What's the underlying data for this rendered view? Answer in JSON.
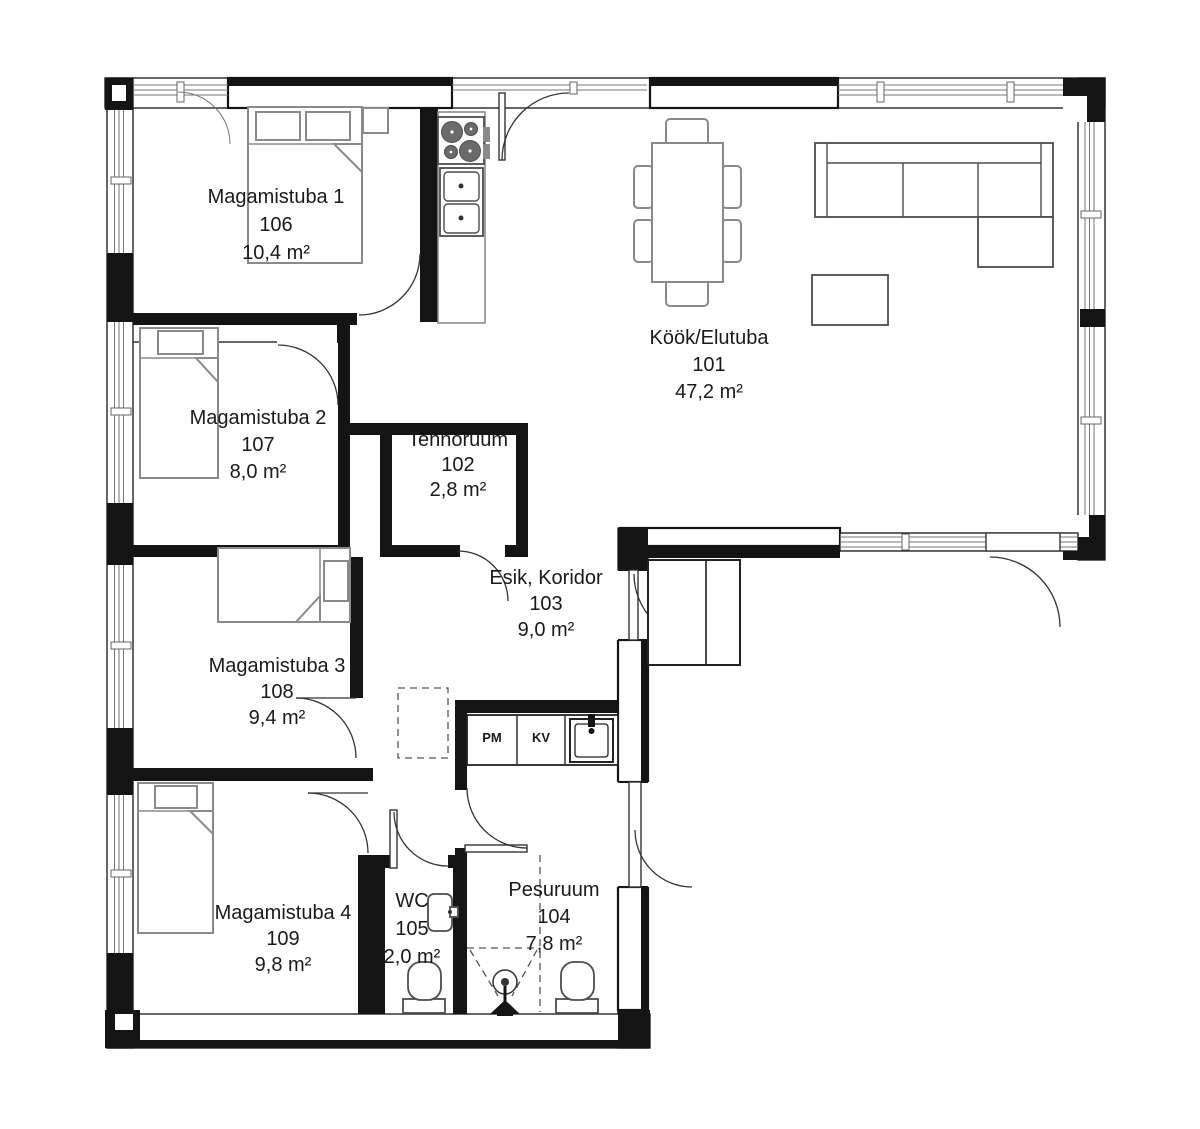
{
  "plan": {
    "rooms": [
      {
        "id": "101",
        "name": "Köök/Elutuba",
        "number": "101",
        "area": "47,2 m²"
      },
      {
        "id": "102",
        "name": "Tehnoruum",
        "number": "102",
        "area": "2,8 m²"
      },
      {
        "id": "103",
        "name": "Esik, Koridor",
        "number": "103",
        "area": "9,0 m²"
      },
      {
        "id": "104",
        "name": "Pesuruum",
        "number": "104",
        "area": "7,8 m²"
      },
      {
        "id": "105",
        "name": "WC",
        "number": "105",
        "area": "2,0 m²"
      },
      {
        "id": "106",
        "name": "Magamistuba 1",
        "number": "106",
        "area": "10,4 m²"
      },
      {
        "id": "107",
        "name": "Magamistuba 2",
        "number": "107",
        "area": "8,0 m²"
      },
      {
        "id": "108",
        "name": "Magamistuba 3",
        "number": "108",
        "area": "9,4 m²"
      },
      {
        "id": "109",
        "name": "Magamistuba 4",
        "number": "109",
        "area": "9,8 m²"
      }
    ],
    "appliances": {
      "washing_machine_label": "PM",
      "dryer_label": "KV"
    },
    "colors": {
      "wall": "#141414",
      "furniture_dark": "#4d4d4d",
      "furniture_gray": "#8a8a8a",
      "background": "#ffffff",
      "text": "#1a1a1a"
    }
  }
}
